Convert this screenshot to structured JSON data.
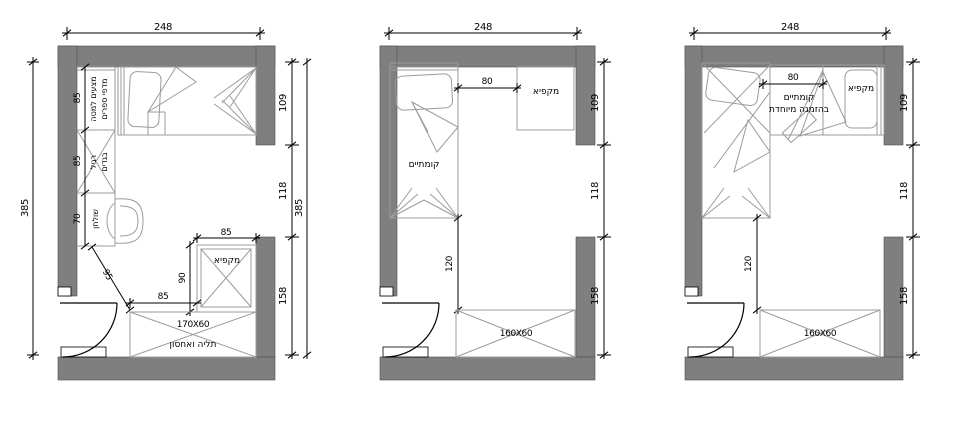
{
  "colors": {
    "wall": "#7f7f7f",
    "line": "#000000",
    "furniture": "#9b9b9b",
    "background": "#ffffff"
  },
  "plans": [
    {
      "id": "plan-a",
      "top_width": "248",
      "left_height": "385",
      "right_segments": [
        "109",
        "118",
        "158"
      ],
      "right_total": "385",
      "wardrobe_segments": [
        "85",
        "85",
        "70"
      ],
      "wardrobe_top_label_line1": "מצעים למטה",
      "wardrobe_top_label_line2": "מדפי ספרים",
      "wardrobe_mid_label_line1": "רגיל",
      "wardrobe_mid_label_line2": "בגדים",
      "desk_label": "שולחן",
      "freezer_label": "מקפיא",
      "freezer_width": "85",
      "freezer_depth": "90",
      "clearance": "85",
      "diagonal_clearance": "95",
      "closet_size": "170X60",
      "closet_label": "תליה ואחסון"
    },
    {
      "id": "plan-b",
      "top_width": "248",
      "right_segments": [
        "109",
        "118",
        "158"
      ],
      "bed_label": "קומתיים",
      "freezer_label": "מקפיא",
      "clearance": "80",
      "bed_to_closet": "120",
      "closet_size": "160X60"
    },
    {
      "id": "plan-c",
      "top_width": "248",
      "right_segments": [
        "109",
        "118",
        "158"
      ],
      "bed_label_line1": "קומתיים",
      "bed_label_line2": "בהזמנה מיוחדת",
      "freezer_label": "מקפיא",
      "clearance": "80",
      "bed_to_closet": "120",
      "closet_size": "160X60"
    }
  ]
}
